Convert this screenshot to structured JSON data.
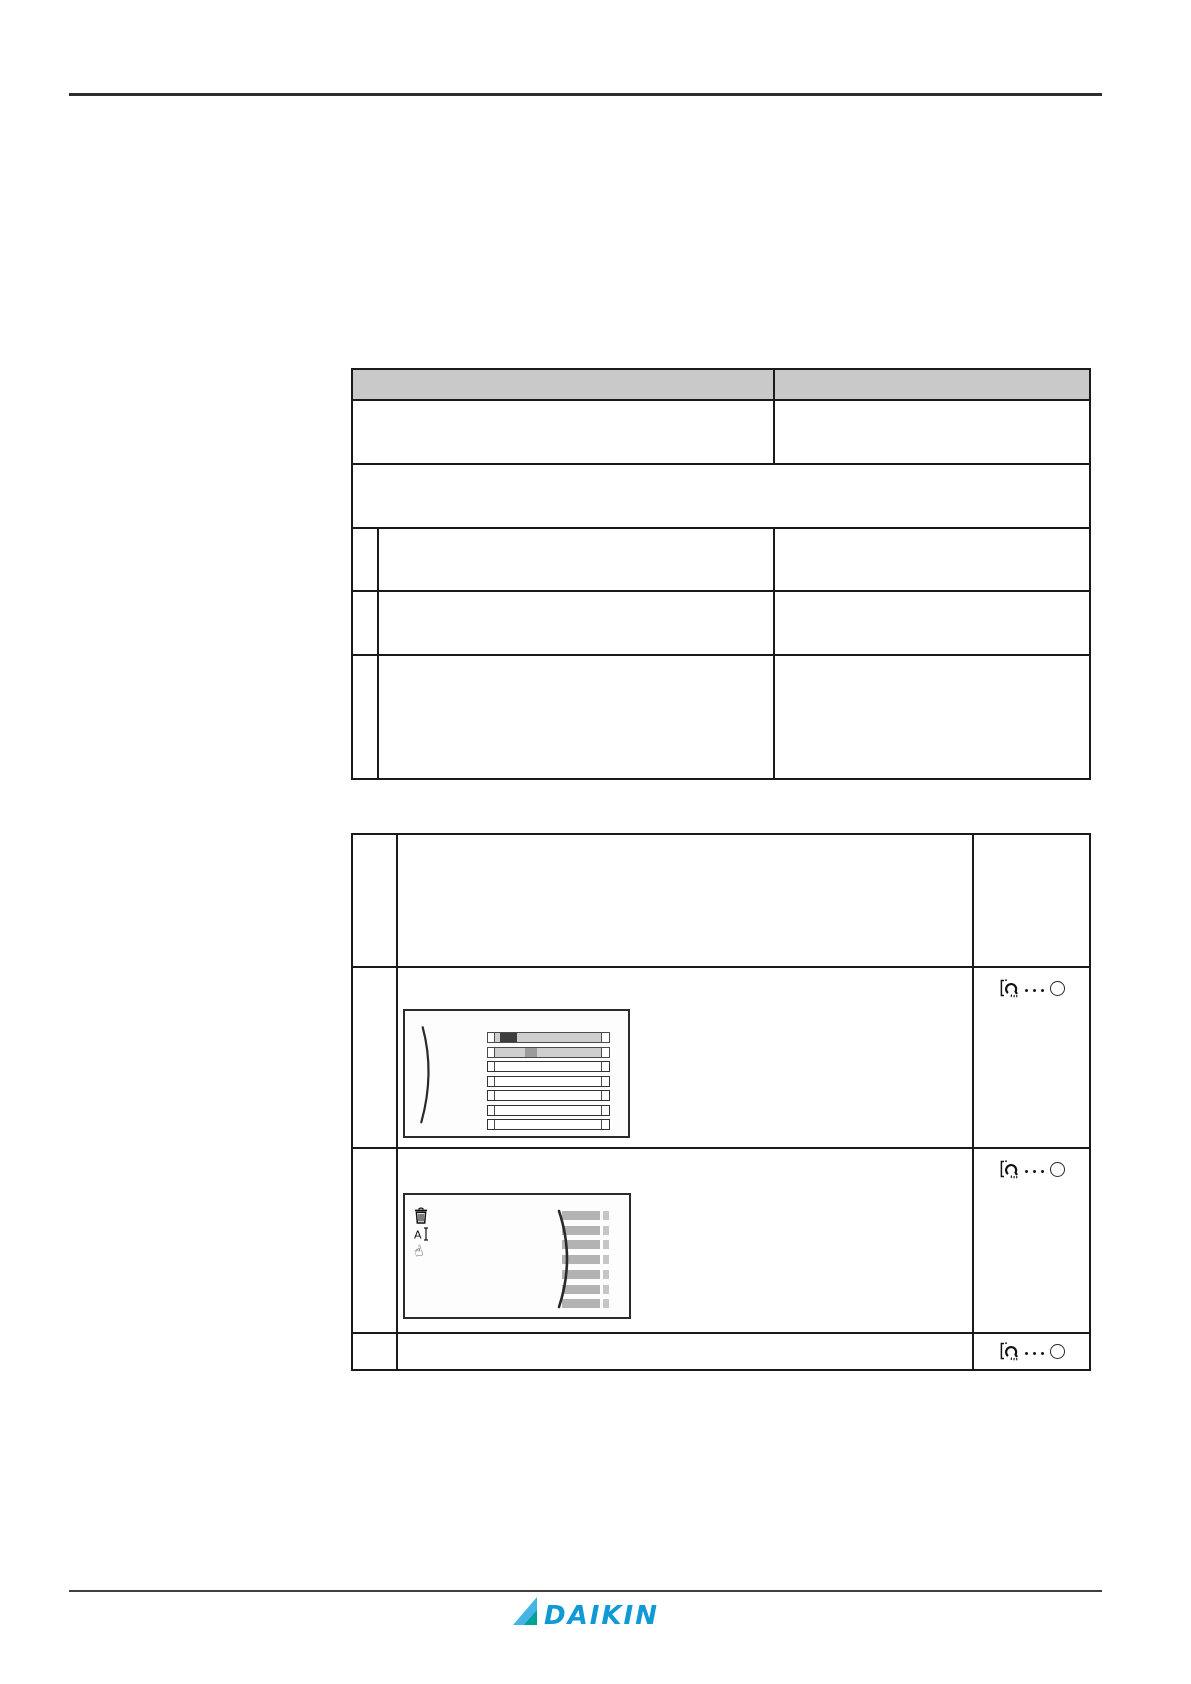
{
  "page": {
    "width": 1191,
    "height": 1684,
    "background": "#ffffff"
  },
  "rules": {
    "top": {
      "x": 69,
      "y": 93,
      "w": 1033,
      "h": 3,
      "color": "#2e2e2e"
    },
    "footer": {
      "x": 69,
      "y": 1590,
      "w": 1033,
      "h": 2,
      "color": "#3f3f3f"
    }
  },
  "table1": {
    "border_color": "#1a1a1a",
    "header_fill": "#c9c9c9",
    "col_widths": [
      26,
      396,
      316
    ],
    "row_heights": [
      31,
      64,
      64,
      63,
      64,
      124
    ],
    "cells": {
      "header": [
        "",
        ""
      ],
      "row1": [
        "",
        ""
      ],
      "row2": [
        ""
      ],
      "row3": [
        "",
        "",
        ""
      ],
      "row4": [
        "",
        "",
        ""
      ],
      "row5": [
        "",
        "",
        ""
      ]
    }
  },
  "table2": {
    "border_color": "#1a1a1a",
    "col_widths": [
      45,
      576,
      117
    ],
    "row_heights": [
      133,
      181,
      185,
      37
    ],
    "cells": {
      "row1": [
        "",
        "",
        ""
      ],
      "row2": [
        "",
        "",
        ""
      ],
      "row3": [
        "",
        "",
        ""
      ],
      "row4": [
        "",
        "",
        ""
      ]
    }
  },
  "screen1": {
    "x": 5,
    "y": 41,
    "w": 227,
    "h": 129,
    "frame_color": "#2b2b2b",
    "bg": "#fdfdfd",
    "arc_color": "#2a2a2a",
    "bars": {
      "x": 82,
      "w": 123,
      "first_y": 21,
      "pitch": 14.5,
      "h": 11,
      "items": [
        {
          "body": "#cfcfcf",
          "outline": "#4a4a4a",
          "segment": {
            "x": 12,
            "w": 17,
            "color": "#3d3d3d"
          }
        },
        {
          "body": "#cfcfcf",
          "outline": "#4a4a4a",
          "segment": {
            "x": 37,
            "w": 12,
            "color": "#9b9b9b"
          }
        },
        {
          "body": "#ffffff",
          "outline": "#333333",
          "segment": null
        },
        {
          "body": "#ffffff",
          "outline": "#333333",
          "segment": null
        },
        {
          "body": "#ffffff",
          "outline": "#333333",
          "segment": null
        },
        {
          "body": "#ffffff",
          "outline": "#333333",
          "segment": null
        },
        {
          "body": "#ffffff",
          "outline": "#333333",
          "segment": null
        }
      ]
    }
  },
  "screen2": {
    "x": 5,
    "y": 44,
    "w": 228,
    "h": 126,
    "frame_color": "#2b2b2b",
    "bg": "#fdfdfd",
    "arc_color": "#2a2a2a",
    "icons": [
      "trash-icon",
      "text-edit-icon",
      "hand-select-icon"
    ],
    "hand_glyph": "☝",
    "bars": {
      "x": 157,
      "w": 38,
      "cap_x": 198,
      "cap_w": 6,
      "first_y": 16,
      "pitch": 14.7,
      "h": 9,
      "count": 7,
      "color": "#b3b3b3",
      "cap_color": "#c6c6c6"
    }
  },
  "icon_group": {
    "meaning": "press-and-hold-button-indicator",
    "dots_count": 3,
    "dot_color": "#1a1a1a",
    "circle_color": "#2a2a2a"
  },
  "footer": {
    "logo_text": "DAIKIN",
    "logo_blue": "#0f9ad7",
    "logo_lightblue": "#45b5e6",
    "logo_teal": "#00a09b"
  }
}
